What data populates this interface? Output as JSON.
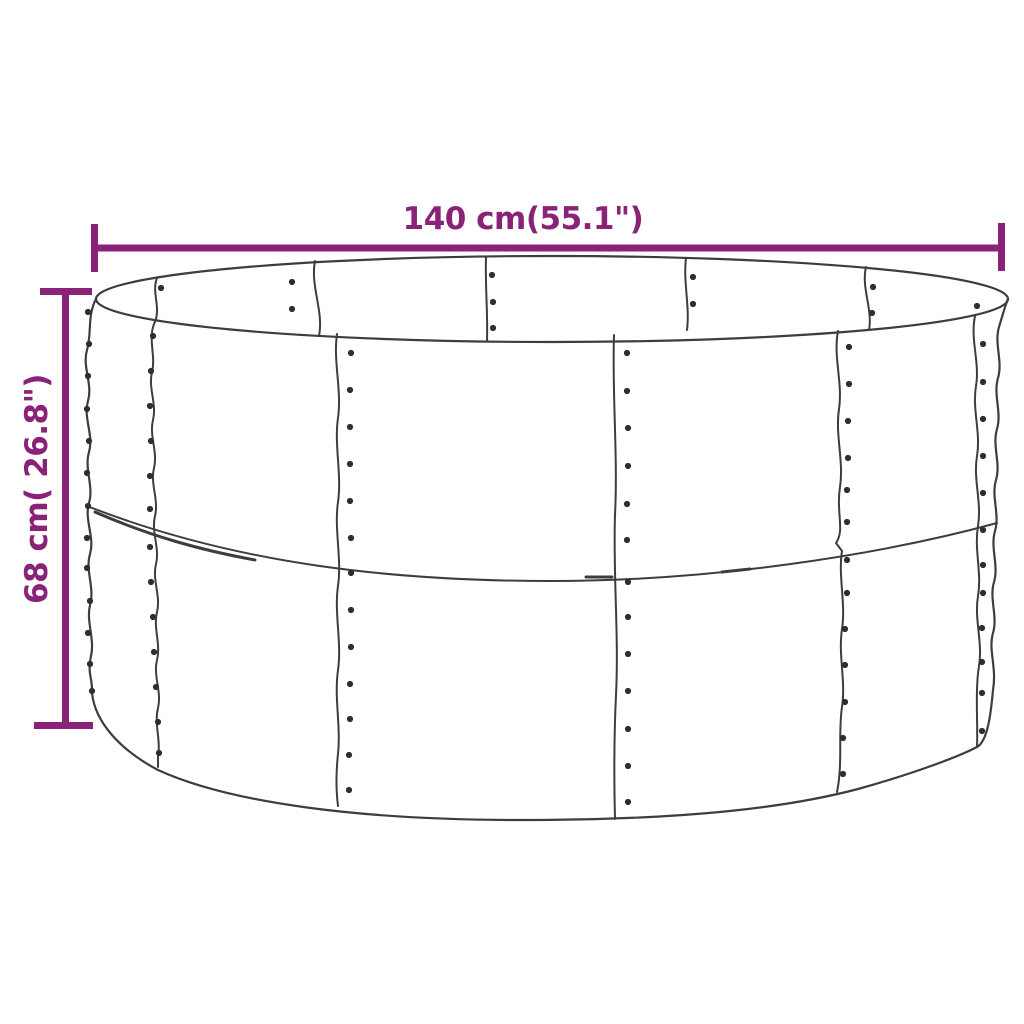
{
  "colors": {
    "accent": "#8a2277",
    "line": "#3d3d3d",
    "rivet": "#2e2e2e",
    "background": "#ffffff"
  },
  "dimensions": {
    "width_label": "140 cm(55.1\")",
    "height_label": "68 cm( 26.8\")"
  },
  "drawing": {
    "rim_ellipse": {
      "cx": 552,
      "cy": 299,
      "rx": 456,
      "ry": 43,
      "w": 2.2
    },
    "paths": [
      {
        "name": "body-outline",
        "w": 2.2,
        "d": "M 96,299 C 87,316 92,333 87,350 C 82,367 93,384 88,401 C 83,418 94,435 89,452 C 84,469 94,486 89,503 C 84,520 95,537 90,554 C 85,571 95,588 90,605 C 86,622 95,639 91,656 C 87,673 93,680 92,693 C 95,722 120,750 158,770 C 230,803 360,820 520,820 C 690,820 790,807 858,789 C 912,774 958,757 977,747 C 988,741 991,712 993,690 C 997,667 988,650 993,633 C 998,616 989,599 994,582 C 999,565 990,548 995,531 C 1000,514 991,497 996,480 C 1001,463 992,446 997,429 C 1002,412 993,395 998,378 C 1003,361 994,344 999,327 C 1003,314 1005,306 1008,299"
      },
      {
        "name": "mid-seam",
        "w": 2,
        "d": "M 87,506 C 240,566 400,581 552,581 C 712,581 880,555 997,523"
      },
      {
        "name": "mid-seam-overlap-1",
        "w": 3,
        "d": "M 95,512 C 150,536 200,550 255,560"
      },
      {
        "name": "mid-seam-overlap-2",
        "w": 3,
        "d": "M 586,577 L 612,577"
      },
      {
        "name": "mid-seam-overlap-3",
        "w": 3,
        "d": "M 722,572 L 750,569"
      },
      {
        "name": "front-seam-1",
        "w": 2,
        "d": "M 157,278 C 151,293 162,308 154,324 C 148,340 156,356 152,372 C 148,388 157,404 153,420 C 149,436 158,452 154,468 C 150,484 159,500 155,516 C 151,532 160,548 156,564 C 152,580 161,596 157,612 C 153,628 161,644 157,660 C 153,676 162,692 158,708 C 154,724 161,740 158,756 L 158,767"
      },
      {
        "name": "front-seam-2",
        "w": 2,
        "d": "M 337,334 C 333,362 342,390 338,418 C 334,446 342,474 338,502 C 334,530 342,558 338,586 C 334,614 342,642 338,670 C 334,698 341,726 338,754 C 336,772 336,790 338,806"
      },
      {
        "name": "front-seam-3",
        "w": 2,
        "d": "M 614,335 C 612,395 618,455 615,515 C 613,575 619,635 616,695 C 614,737 614,779 615,819"
      },
      {
        "name": "front-seam-4",
        "w": 2,
        "d": "M 838,331 C 833,357 843,383 839,409 C 835,435 844,461 840,487 C 836,513 845,530 836,543 L 842,551 C 838,577 846,603 842,629 C 838,655 846,681 842,707 C 838,733 843,763 837,792"
      },
      {
        "name": "front-seam-5",
        "w": 2,
        "d": "M 975,316 C 970,340 980,362 976,386 C 972,410 981,432 977,456 C 973,480 982,502 978,526 C 974,550 982,572 978,596 C 974,620 983,642 979,666 C 975,690 978,724 977,747"
      },
      {
        "name": "rim-seam-2",
        "w": 2,
        "d": "M 315,261 C 310,286 324,311 319,336"
      },
      {
        "name": "rim-seam-3",
        "w": 2,
        "d": "M 486,257 C 485,285 488,313 487,341"
      },
      {
        "name": "rim-seam-4",
        "w": 2,
        "d": "M 686,258 C 683,282 690,306 687,330"
      },
      {
        "name": "rim-seam-5",
        "w": 2,
        "d": "M 866,267 C 861,288 873,309 869,330"
      }
    ],
    "rivet_radius": 3.1,
    "rivets": [
      [
        161,
        288
      ],
      [
        292,
        282
      ],
      [
        292,
        309
      ],
      [
        492,
        275
      ],
      [
        493,
        302
      ],
      [
        493,
        328
      ],
      [
        693,
        277
      ],
      [
        693,
        304
      ],
      [
        873,
        287
      ],
      [
        872,
        313
      ],
      [
        977,
        306
      ],
      [
        88,
        312
      ],
      [
        89,
        344
      ],
      [
        88,
        376
      ],
      [
        87,
        409
      ],
      [
        89,
        441
      ],
      [
        87,
        473
      ],
      [
        88,
        506
      ],
      [
        87,
        538
      ],
      [
        87,
        568
      ],
      [
        90,
        601
      ],
      [
        88,
        633
      ],
      [
        90,
        664
      ],
      [
        92,
        691
      ],
      [
        153,
        336
      ],
      [
        151,
        371
      ],
      [
        150,
        406
      ],
      [
        151,
        441
      ],
      [
        150,
        476
      ],
      [
        150,
        509
      ],
      [
        150,
        547
      ],
      [
        151,
        582
      ],
      [
        153,
        617
      ],
      [
        154,
        652
      ],
      [
        156,
        687
      ],
      [
        158,
        722
      ],
      [
        159,
        753
      ],
      [
        351,
        353
      ],
      [
        350,
        390
      ],
      [
        350,
        427
      ],
      [
        350,
        464
      ],
      [
        350,
        501
      ],
      [
        351,
        538
      ],
      [
        351,
        573
      ],
      [
        351,
        610
      ],
      [
        351,
        647
      ],
      [
        350,
        684
      ],
      [
        350,
        719
      ],
      [
        349,
        755
      ],
      [
        349,
        790
      ],
      [
        627,
        353
      ],
      [
        627,
        391
      ],
      [
        628,
        428
      ],
      [
        628,
        466
      ],
      [
        627,
        504
      ],
      [
        627,
        540
      ],
      [
        628,
        582
      ],
      [
        628,
        617
      ],
      [
        628,
        654
      ],
      [
        628,
        691
      ],
      [
        628,
        729
      ],
      [
        628,
        766
      ],
      [
        628,
        802
      ],
      [
        849,
        347
      ],
      [
        849,
        384
      ],
      [
        848,
        421
      ],
      [
        848,
        458
      ],
      [
        847,
        490
      ],
      [
        847,
        522
      ],
      [
        847,
        560
      ],
      [
        847,
        593
      ],
      [
        845,
        629
      ],
      [
        845,
        665
      ],
      [
        845,
        702
      ],
      [
        843,
        738
      ],
      [
        843,
        774
      ],
      [
        983,
        344
      ],
      [
        983,
        382
      ],
      [
        983,
        419
      ],
      [
        983,
        456
      ],
      [
        983,
        493
      ],
      [
        983,
        530
      ],
      [
        983,
        565
      ],
      [
        983,
        593
      ],
      [
        982,
        628
      ],
      [
        982,
        662
      ],
      [
        982,
        693
      ],
      [
        982,
        731
      ]
    ]
  }
}
